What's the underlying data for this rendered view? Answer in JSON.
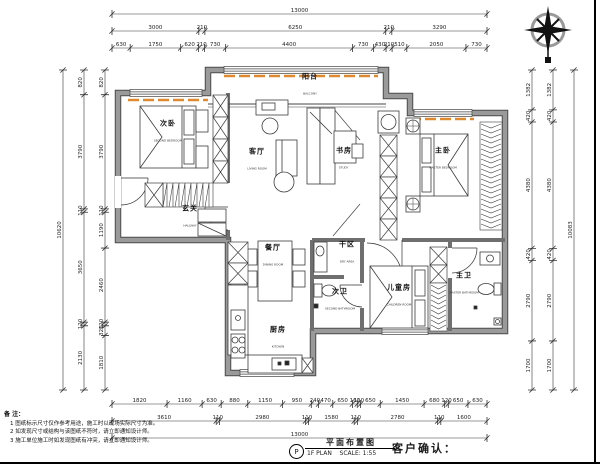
{
  "sheet": {
    "title_cn": "平面布置图",
    "title_en": "1F PLAN",
    "scale": "SCALE: 1:55",
    "circle_mark": "P",
    "customer_confirm": "客户确认："
  },
  "notes": {
    "heading": "备 注：",
    "items": [
      "1  图纸标示尺寸仅作参考用途，施工时以现场实际尺寸为准。",
      "2  如发现尺寸或结构与该图纸不符时，请立即通知设计师。",
      "3  施工单位施工时如发现图纸有冲突，请立即通知设计师。"
    ]
  },
  "rooms": [
    {
      "id": "bedroom-second",
      "cn": "次卧",
      "en": "SECOND BEDROOM",
      "x": 168,
      "y": 133
    },
    {
      "id": "balcony",
      "cn": "阳台",
      "en": "BALCONY",
      "x": 310,
      "y": 86
    },
    {
      "id": "living-room",
      "cn": "客厅",
      "en": "LIVING ROOM",
      "x": 257,
      "y": 161
    },
    {
      "id": "study",
      "cn": "书房",
      "en": "STUDY",
      "x": 344,
      "y": 160
    },
    {
      "id": "bedroom-master",
      "cn": "主卧",
      "en": "MASTER BEDROOM",
      "x": 443,
      "y": 160
    },
    {
      "id": "entry",
      "cn": "玄关",
      "en": "HALLWAY",
      "x": 190,
      "y": 218
    },
    {
      "id": "dining-room",
      "cn": "餐厅",
      "en": "DINING ROOM",
      "x": 273,
      "y": 257
    },
    {
      "id": "dry-area",
      "cn": "干区",
      "en": "DRY AREA",
      "x": 347,
      "y": 254
    },
    {
      "id": "bathroom-second",
      "cn": "次卫",
      "en": "SECOND BATHROOM",
      "x": 340,
      "y": 301
    },
    {
      "id": "kids-room",
      "cn": "儿童房",
      "en": "CHILDREN ROOM",
      "x": 399,
      "y": 297
    },
    {
      "id": "bathroom-master",
      "cn": "主卫",
      "en": "MASTER BATHROOM",
      "x": 464,
      "y": 285
    },
    {
      "id": "kitchen",
      "cn": "厨房",
      "en": "KITCHEN",
      "x": 278,
      "y": 339
    }
  ],
  "dimensions": {
    "top_rows": [
      [
        13000
      ],
      [
        3000,
        210,
        6250,
        210,
        3290
      ],
      [
        630,
        1750,
        620,
        210,
        730,
        4400,
        730,
        430,
        210,
        510,
        2050,
        730
      ]
    ],
    "bottom_rows": [
      [
        1820,
        1160,
        630,
        880,
        1150,
        950,
        240,
        470,
        650,
        160,
        110,
        650,
        1450,
        680,
        120,
        650,
        630
      ],
      [
        3610,
        110,
        2980,
        110,
        1580,
        110,
        2780,
        110,
        1600
      ],
      [
        13000
      ]
    ],
    "left_cols": [
      [
        10620
      ],
      [
        820,
        3790,
        110,
        3650,
        120,
        2130
      ],
      [
        820,
        3790,
        110,
        1190,
        2460,
        120,
        320,
        1810
      ]
    ],
    "right_cols": [
      [
        1382,
        420,
        4380,
        420,
        2790,
        1700
      ],
      [
        1382,
        420,
        4380,
        420,
        2790,
        1700
      ],
      [
        10083
      ]
    ]
  },
  "colors": {
    "wall_fill": "#9a9a9a",
    "wall_edge": "#4a4a4a",
    "accent_orange": "#e08a30",
    "line": "#2a2a2a",
    "dim_text": "#222222"
  }
}
